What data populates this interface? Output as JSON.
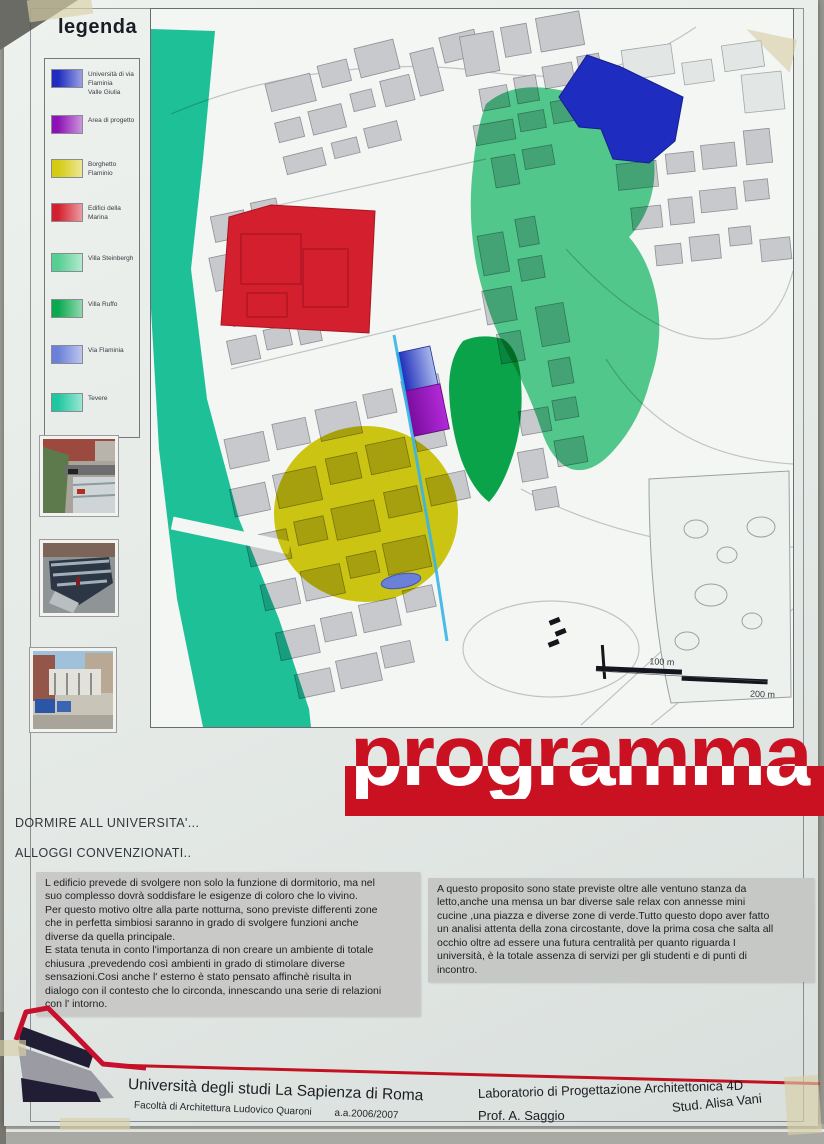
{
  "poster": {
    "legend": {
      "title": "legenda",
      "items": [
        {
          "label": "Università di via Flaminia",
          "label2": "Valle Giulia",
          "color": "#1e2cc0"
        },
        {
          "label": "Area di progetto",
          "color": "#8d12b5"
        },
        {
          "label": "Borghetto Flaminio",
          "color": "#d5cb12"
        },
        {
          "label": "Edifici della Marina",
          "color": "#d4202e"
        },
        {
          "label": "Villa Steinbergh",
          "color": "#55cf92"
        },
        {
          "label": "Villa Ruffo",
          "color": "#0aa94e"
        },
        {
          "label": "Via Flaminia",
          "color": "#6b80d8"
        },
        {
          "label": "Tevere",
          "color": "#1fc79f"
        }
      ],
      "photos": [
        "market-aerial-view",
        "market-roof-view",
        "market-street-view"
      ]
    },
    "map": {
      "scale_labels": [
        "100 m",
        "200 m"
      ],
      "via_flaminia_line_color": "#35b5ea"
    },
    "banner": {
      "title": "programma",
      "color": "#c91122"
    },
    "intro_lines": {
      "line1": "DORMIRE ALL UNIVERSITA'...",
      "line2": "ALLOGGI CONVENZIONATI.."
    },
    "paragraphs": {
      "left": "L edificio prevede di svolgere non solo la funzione di dormitorio, ma nel\nsuo complesso dovrà soddisfare le esigenze  di coloro che lo vivino.\nPer questo motivo oltre alla parte notturna, sono previste differenti zone\nche in perfetta simbiosi saranno in grado di svolgere funzioni anche\ndiverse da quella principale.\nE stata tenuta in conto l'importanza di non creare un ambiente di totale\nchiusura ,prevedendo così ambienti in grado di stimolare diverse\nsensazioni.Cosi anche l' esterno è stato pensato affinchè risulta in\ndialogo con il contesto che lo circonda, innescando una serie di relazioni\ncon l' intorno.",
      "right": "A questo proposito sono state previste oltre alle ventuno stanza da\nletto,anche una mensa un bar diverse sale relax con annesse mini\ncucine ,una piazza e diverse zone di verde.Tutto questo dopo aver fatto\nun analisi attenta della zona circostante, dove la prima cosa che salta all\nocchio oltre ad essere una futura centralità per quanto riguarda I\nuniversità, è la totale assenza di servizi per gli studenti e di punti di\nincontro."
    },
    "footer": {
      "university": "Università degli studi La Sapienza di Roma",
      "faculty": "Facoltà di Architettura Ludovico Quaroni",
      "year": "a.a.2006/2007",
      "lab": "Laboratorio di Progettazione Architettonica 4D",
      "professor": "Prof. A. Saggio",
      "student": "Stud. Alisa Vani"
    }
  }
}
